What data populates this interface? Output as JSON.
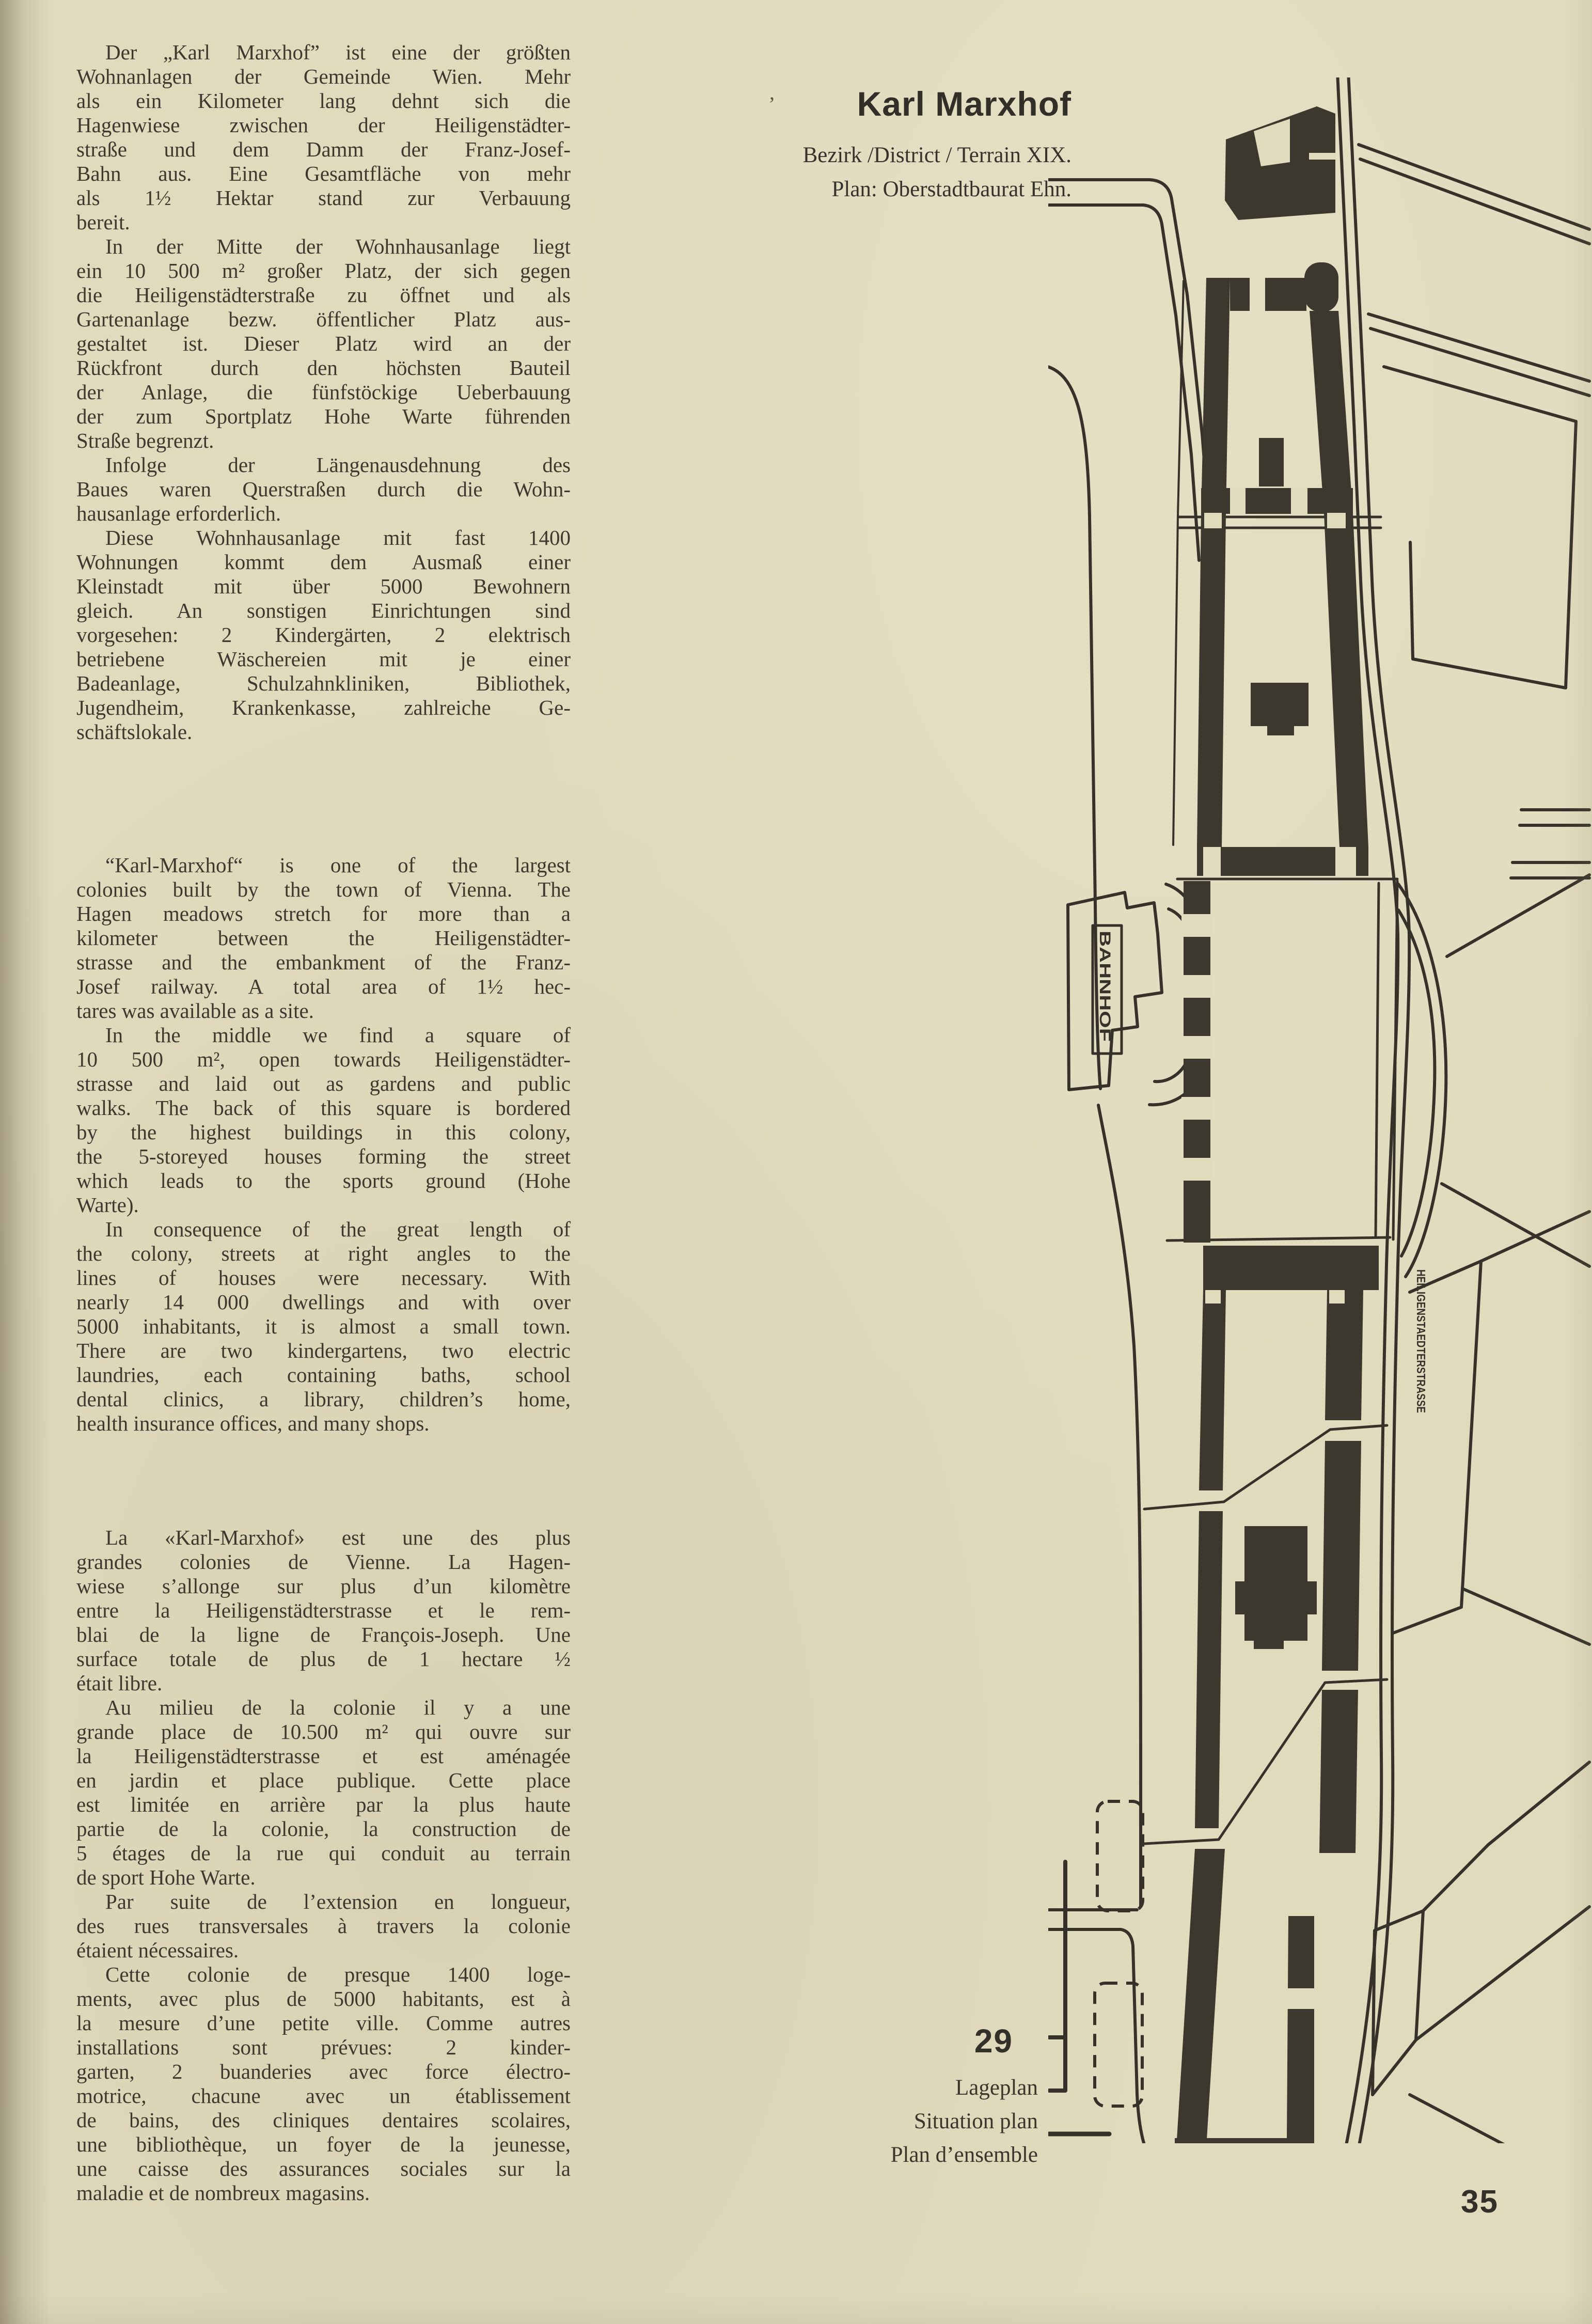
{
  "page": {
    "number": "35",
    "paper_color": "#e1dbbe",
    "ink_color": "#3e392e"
  },
  "header": {
    "artifact_mark": "’",
    "title": "Karl Marxhof",
    "subtitle_line1": "Bezirk /District / Terrain XIX.",
    "subtitle_line2": "Plan: Oberstadtbaurat Ehn."
  },
  "figure_caption": {
    "number": "29",
    "lines": [
      "Lageplan",
      "Situation plan",
      "Plan d’ensemble"
    ]
  },
  "map_labels": {
    "station": "BAHNHOF",
    "street": "HEILIGENSTAEDTERSTRASSE"
  },
  "text_blocks": [
    {
      "id": "german",
      "paragraphs": [
        [
          "Der „Karl Marxhof” ist eine der größten",
          "Wohnanlagen der Gemeinde Wien. Mehr",
          "als ein Kilometer lang dehnt sich die",
          "Hagenwiese zwischen der Heiligenstädter-",
          "straße und dem Damm der Franz-Josef-",
          "Bahn aus. Eine Gesamtfläche von mehr",
          "als 1½ Hektar stand zur Verbauung",
          "bereit."
        ],
        [
          "In der Mitte der Wohnhausanlage liegt",
          "ein 10 500 m² großer Platz, der sich gegen",
          "die Heiligenstädterstraße zu öffnet und als",
          "Gartenanlage bezw. öffentlicher Platz aus-",
          "gestaltet ist. Dieser Platz wird an der",
          "Rückfront durch den höchsten Bauteil",
          "der Anlage, die fünfstöckige Ueberbauung",
          "der zum Sportplatz Hohe Warte führenden",
          "Straße begrenzt."
        ],
        [
          "Infolge der Längenausdehnung des",
          "Baues waren Querstraßen durch die Wohn-",
          "hausanlage erforderlich."
        ],
        [
          "Diese Wohnhausanlage mit fast 1400",
          "Wohnungen kommt dem Ausmaß einer",
          "Kleinstadt mit über 5000 Bewohnern",
          "gleich. An sonstigen Einrichtungen sind",
          "vorgesehen: 2 Kindergärten, 2 elektrisch",
          "betriebene Wäschereien mit je einer",
          "Badeanlage, Schulzahnkliniken, Bibliothek,",
          "Jugendheim, Krankenkasse, zahlreiche Ge-",
          "schäftslokale."
        ]
      ]
    },
    {
      "id": "english",
      "paragraphs": [
        [
          "“Karl-Marxhof“ is one of the largest",
          "colonies built by the town of Vienna. The",
          "Hagen meadows stretch for more than a",
          "kilometer between the Heiligenstädter-",
          "strasse and the embankment of the Franz-",
          "Josef railway. A total area of 1½ hec-",
          "tares was available as a site."
        ],
        [
          "In the middle we find a square of",
          "10 500 m², open towards Heiligenstädter-",
          "strasse and laid out as gardens and public",
          "walks. The back of this square is bordered",
          "by the highest buildings in this colony,",
          "the 5-storeyed houses forming the street",
          "which leads to the sports ground (Hohe",
          "Warte)."
        ],
        [
          "In consequence of the great length of",
          "the colony, streets at right angles to the",
          "lines of houses were necessary. With",
          "nearly 14 000 dwellings and with over",
          "5000 inhabitants, it is almost a small town.",
          "There are two kindergartens, two electric",
          "laundries, each containing baths, school",
          "dental clinics, a library, children’s home,",
          "health insurance offices, and many shops."
        ]
      ]
    },
    {
      "id": "french",
      "paragraphs": [
        [
          "La «Karl-Marxhof» est une des plus",
          "grandes colonies de Vienne. La Hagen-",
          "wiese s’allonge sur plus d’un kilomètre",
          "entre la Heiligenstädterstrasse et le rem-",
          "blai de la ligne de François-Joseph. Une",
          "surface totale de plus de 1 hectare ½",
          "était libre."
        ],
        [
          "Au milieu de la colonie il y a une",
          "grande place de 10.500 m² qui ouvre sur",
          "la Heiligenstädterstrasse et est aménagée",
          "en jardin et place publique. Cette place",
          "est limitée en arrière par la plus haute",
          "partie de la colonie, la construction de",
          "5 étages de la rue qui conduit au terrain",
          "de sport Hohe Warte."
        ],
        [
          "Par suite de l’extension en longueur,",
          "des rues transversales à travers la colonie",
          "étaient nécessaires."
        ],
        [
          "Cette colonie de presque 1400 loge-",
          "ments, avec plus de 5000 habitants, est à",
          "la mesure d’une petite ville. Comme autres",
          "installations sont prévues: 2 kinder-",
          "garten, 2 buanderies avec force électro-",
          "motrice, chacune avec un établissement",
          "de bains, des cliniques dentaires scolaires,",
          "une bibliothèque, un foyer de la jeunesse,",
          "une caisse des assurances sociales sur la",
          "maladie et de nombreux magasins."
        ]
      ]
    }
  ]
}
